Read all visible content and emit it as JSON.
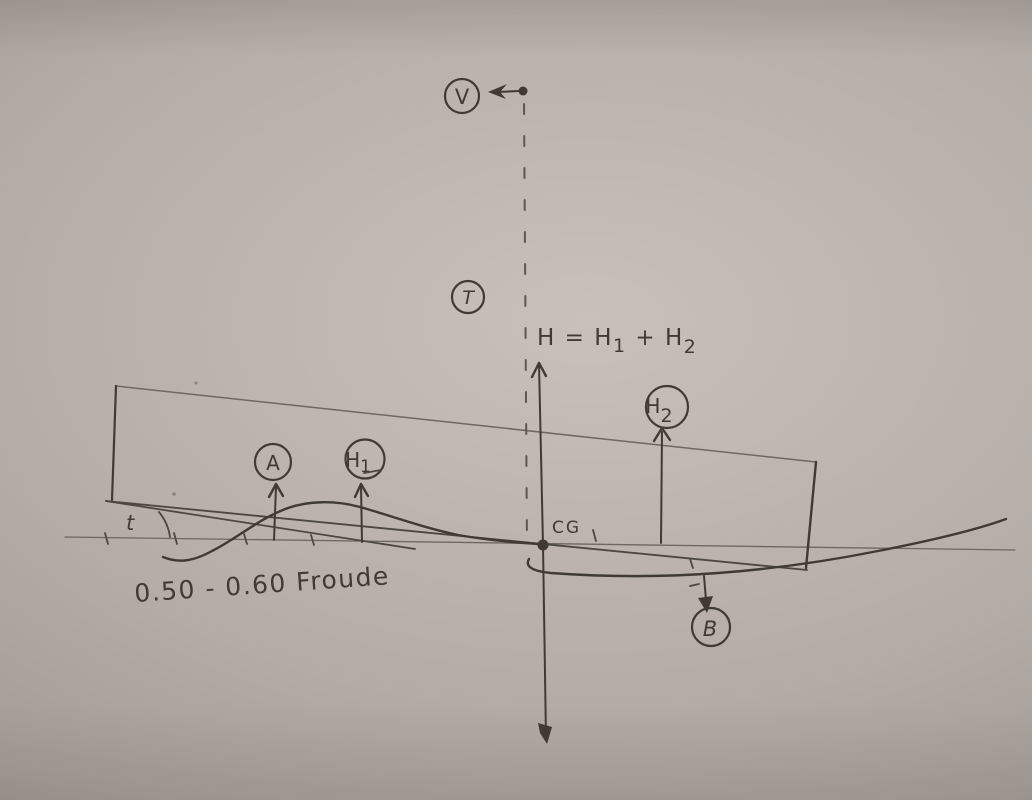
{
  "colors": {
    "paper": "#b5ada6",
    "paper_light": "#c8c0b9",
    "paper_dark": "#948c86",
    "ink": "#403a35",
    "ink_med": "#4d4741",
    "ink_thin": "#6e6861"
  },
  "labels": {
    "v": "V",
    "t_thrust": "T",
    "trim_angle": "t",
    "cg": "CG",
    "a": "A",
    "b": "B",
    "minus": "-",
    "equation": {
      "p1": "H = H",
      "sub1": "1",
      "p2": " + H",
      "sub2": "2"
    },
    "h1": {
      "main": "H",
      "sub": "1"
    },
    "h2": {
      "main": "H",
      "sub": "2"
    },
    "froude": "0.50 - 0.60  Froude"
  }
}
